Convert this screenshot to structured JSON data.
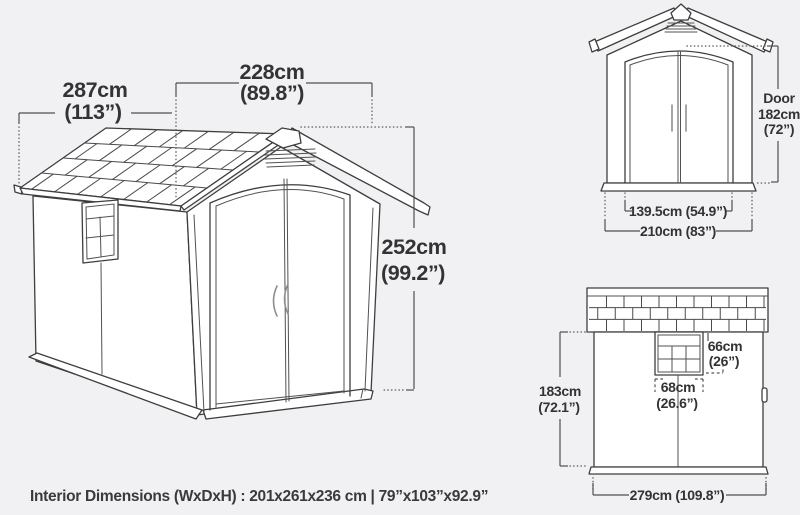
{
  "colors": {
    "background": "#f1f1f3",
    "line": "#3e3e3e",
    "text": "#333333"
  },
  "main_view": {
    "depth_cm": "287cm",
    "depth_in": "(113”)",
    "width_cm": "228cm",
    "width_in": "(89.8”)",
    "height_cm": "252cm",
    "height_in": "(99.2”)"
  },
  "front_view": {
    "door_label": "Door",
    "door_height_cm": "182cm",
    "door_height_in": "(72”)",
    "door_width": "139.5cm (54.9”)",
    "overall_width": "210cm (83”)"
  },
  "side_view": {
    "window_height_cm": "66cm",
    "window_height_in": "(26”)",
    "window_width_cm": "68cm",
    "window_width_in": "(26.6”)",
    "wall_height_cm": "183cm",
    "wall_height_in": "(72.1”)",
    "overall_width": "279cm (109.8”)"
  },
  "footer": {
    "interior_dimensions": "Interior Dimensions (WxDxH) : 201x261x236 cm | 79”x103”x92.9”"
  }
}
